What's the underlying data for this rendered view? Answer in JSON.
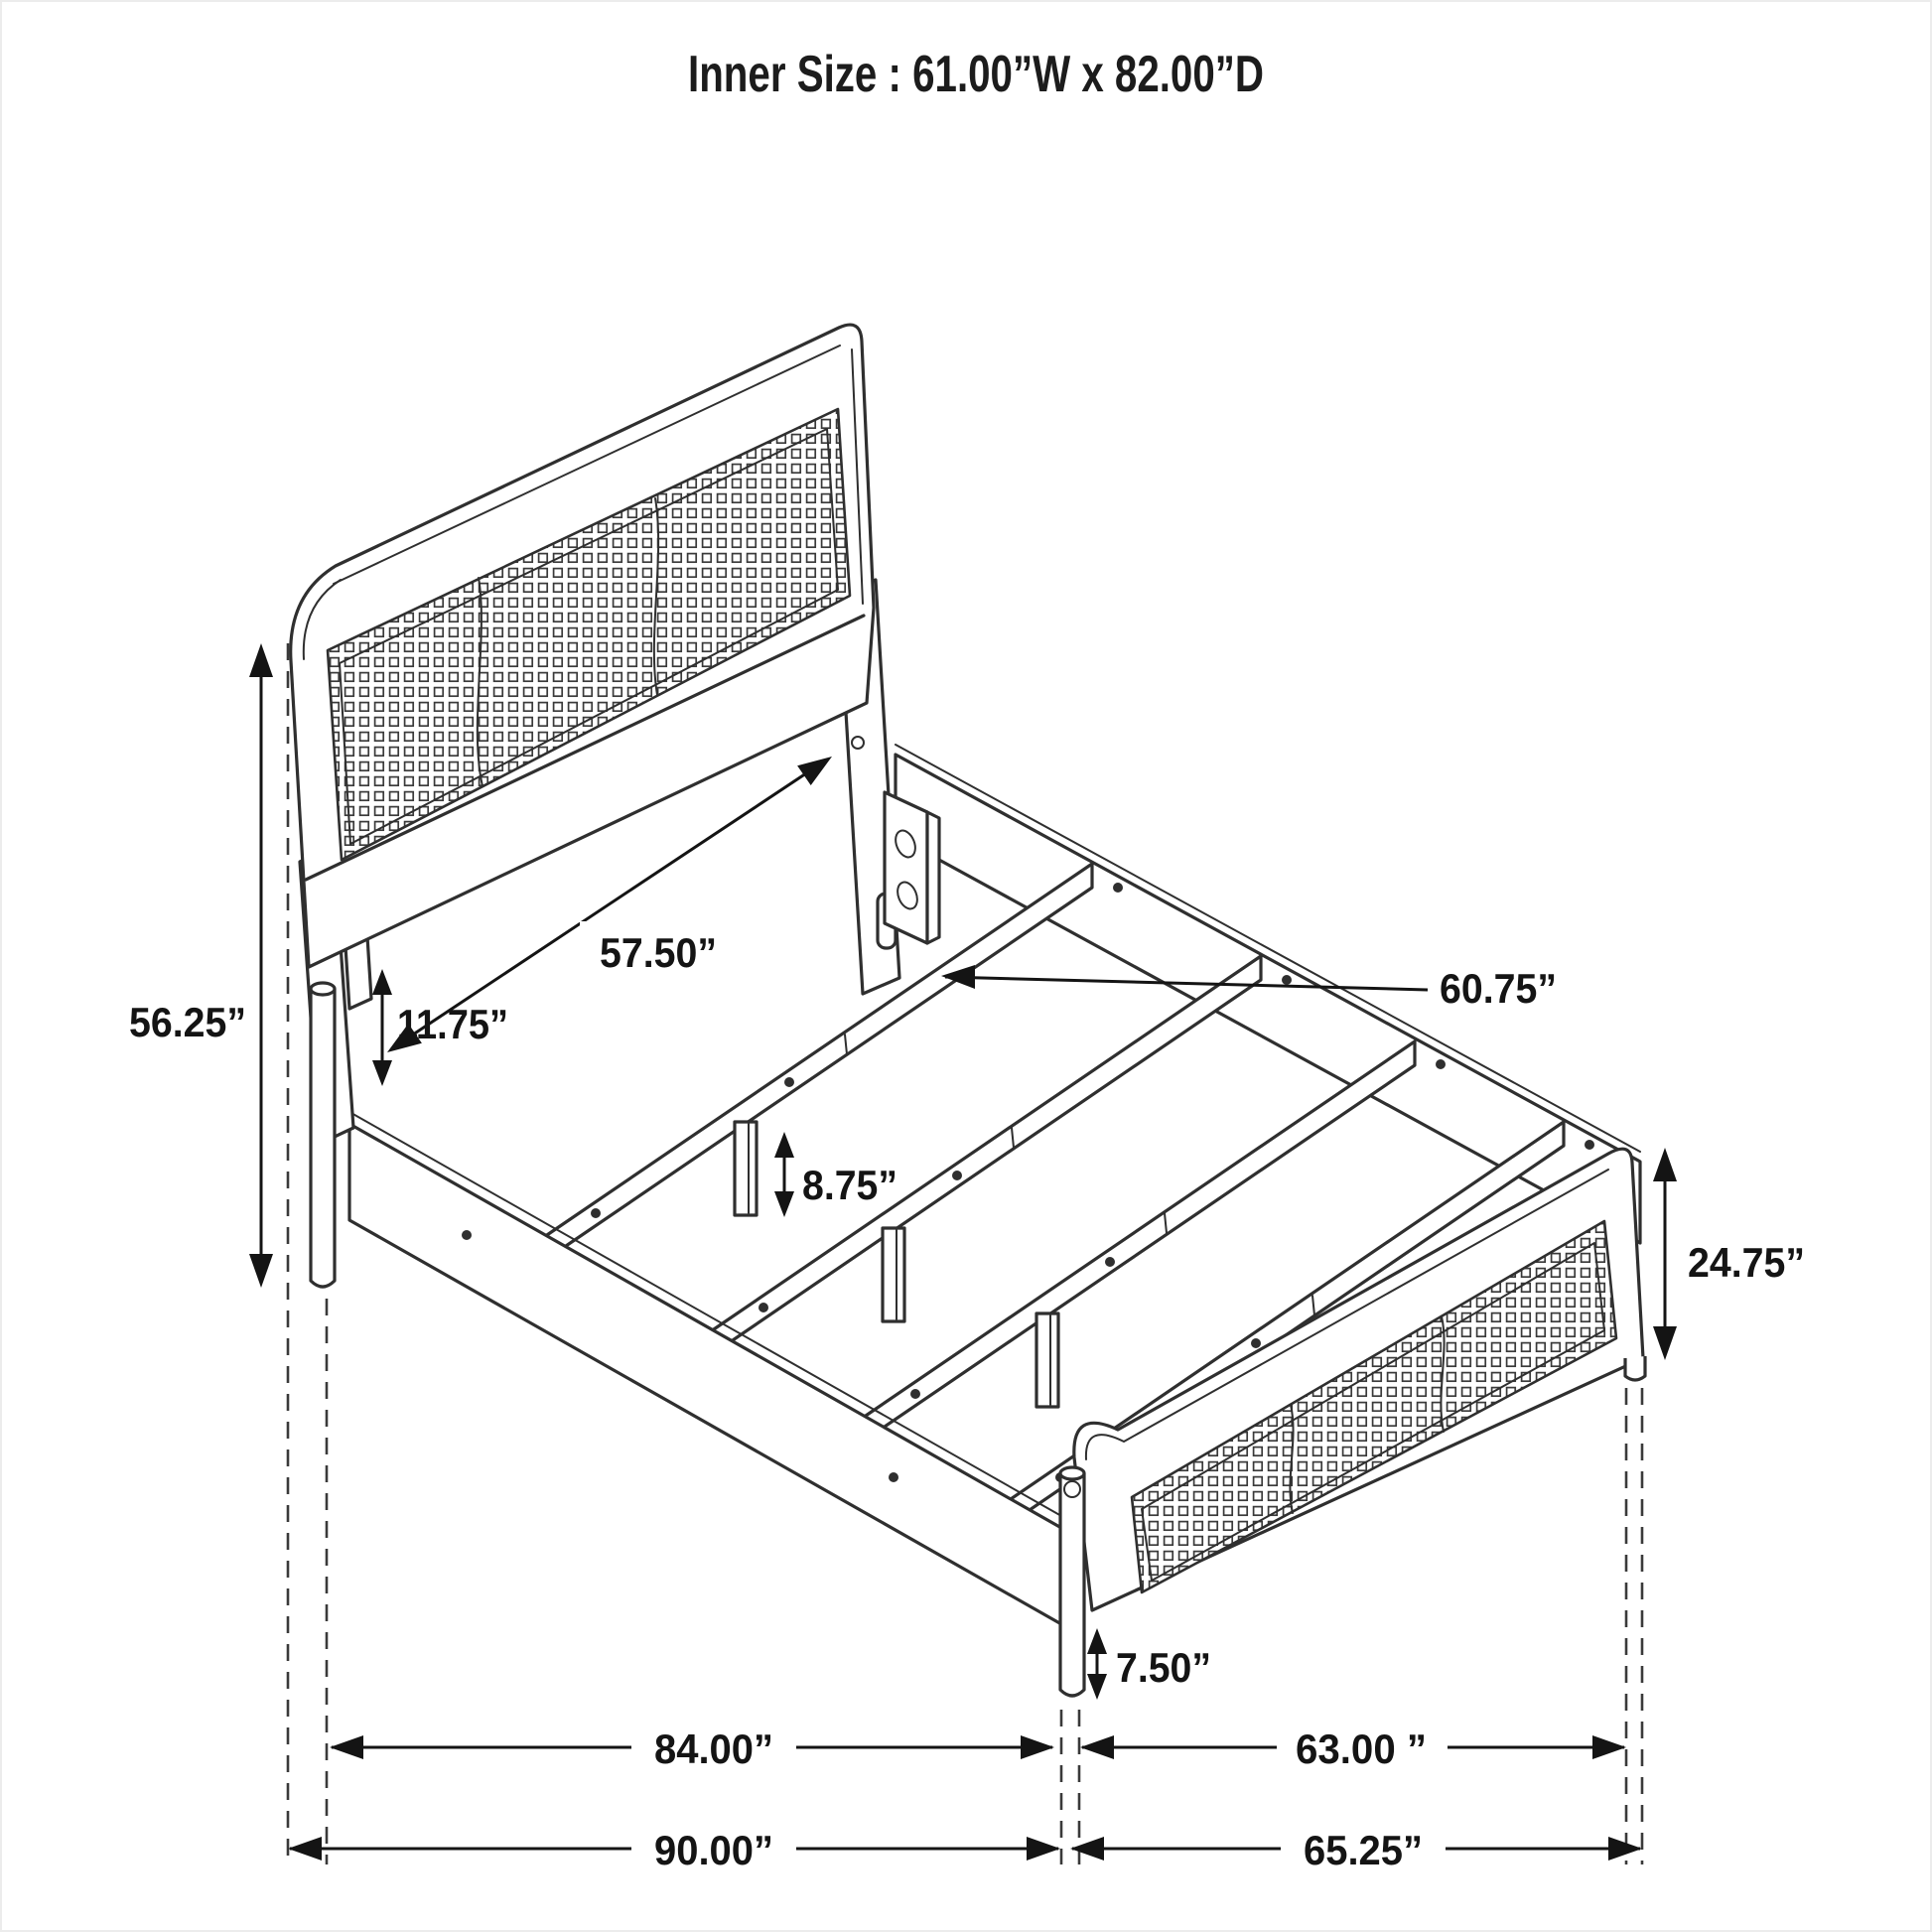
{
  "title": "Inner Size : 61.00”W x 82.00”D",
  "diagram": {
    "type": "isometric furniture dimension drawing",
    "subject": "bed frame with woven cane headboard and footboard",
    "line_color": "#2f2f2f",
    "background": "#ffffff",
    "dimensions": {
      "inner_size_width": "61.00”W",
      "inner_size_depth": "82.00”D",
      "headboard_height": "56.25”",
      "headboard_width": "57.50”",
      "headboard_rail_gap": "11.75”",
      "center_leg_height": "8.75”",
      "slat_length": "60.75”",
      "footboard_height": "24.75”",
      "footboard_leg_height": "7.50”",
      "inner_length": "84.00”",
      "footboard_width": "63.00 ”",
      "overall_length": "90.00”",
      "overall_width": "65.25”"
    }
  }
}
